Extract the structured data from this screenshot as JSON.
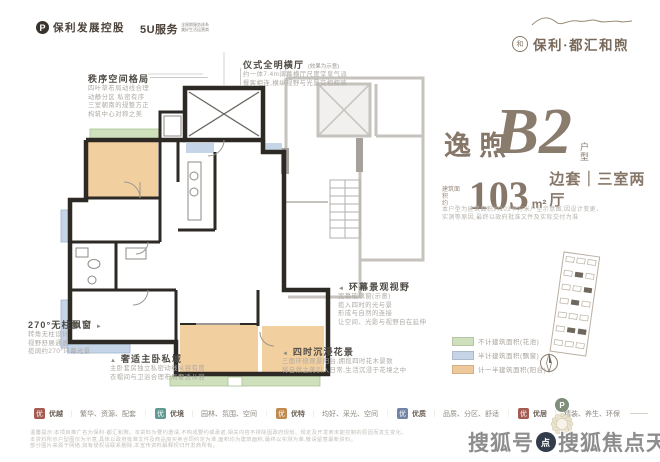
{
  "header": {
    "developer_mark": "P",
    "developer_name": "保利发展控股",
    "service_brand": "5U服务",
    "service_brand_sub1": "全周期服务体系",
    "service_brand_sub2": "美好生活运营商",
    "project_emblem": "和",
    "project_name": "保利·都汇和煦"
  },
  "unit": {
    "series_name": "逸煦",
    "unit_code": "B2",
    "unit_code_suffix": "户型",
    "area_prefix_line1": "建筑面积",
    "area_prefix_line2": "约",
    "area_value": "103",
    "area_unit": "m²",
    "area_layout": "边套｜三室两厅",
    "note_line1": "本户型为建筑面积约103平方米户型示意图,因设计变更、",
    "note_line2": "实测等原因,最终以政府批准文件及实际交付为准"
  },
  "annotations": {
    "order": {
      "title": "秩序空间格局",
      "lines": [
        "四叶草布局动线合理",
        "动静分区 私密有序",
        "三室朝南的规整方正",
        "构筑中心对称之美"
      ]
    },
    "hall": {
      "title": "仪式全明横厅",
      "suffix": "(效果为示意)",
      "lines": [
        "约一体7.4m阔幕横厅尺度堂皇气派",
        "餐客相连,横纵视野与光景交相辉映"
      ]
    },
    "view": {
      "title": "环幕景观视野",
      "arrow": "◄",
      "lines": [
        "宽幕玻璃窗(示意)",
        "揽入四时的光与景",
        "形成与自然的连接",
        "让空间、光影与视野自在延伸"
      ]
    },
    "baywindow": {
      "title": "270°无柱飘窗",
      "arrow": "►",
      "lines": [
        "转角无柱设计",
        "视野舒展通透",
        "揽阔约270°环幕光景"
      ]
    },
    "master": {
      "title": "奢适主卧私域",
      "arrow": "▲",
      "lines": [
        "主卧套房独立私密动线从容有度",
        "衣帽间与卫浴合理布局奢适从容"
      ]
    },
    "garden": {
      "title": "四时沉浸花景",
      "arrow": "◄",
      "lines": [
        "三面环绕观景阳台,拥揽四时花木景致",
        "将自然之美引入日常,生活沉浸于花境之中"
      ]
    }
  },
  "legend": {
    "items": [
      {
        "label": "不计建筑面积(花池)",
        "style": "background:#cfe0bd"
      },
      {
        "label": "半计建筑面积(飘窗)",
        "style": "background:#c5d4e6"
      },
      {
        "label": "计一半建筑面积(阳台)",
        "style": "background:#eec99b"
      }
    ],
    "colors": [
      "#cfe0bd",
      "#c5d4e6",
      "#eec99b"
    ]
  },
  "plan_colors": {
    "wall": "#2d2925",
    "neighbor": "#c6c3be",
    "flower_bed_green": "#cfe0bd",
    "bay_window_blue": "#c5d4e6",
    "balcony_orange": "#f2cf9e"
  },
  "services": {
    "icon_glyph": "优",
    "items": [
      {
        "name": "优越",
        "desc": "繁华、资源、配套",
        "style": "background:#a65b52"
      },
      {
        "name": "优境",
        "desc": "园林、氛围、空间",
        "style": "background:#5f9b93"
      },
      {
        "name": "优特",
        "desc": "均好、采光、空间",
        "style": "background:#c0894e"
      },
      {
        "name": "优质",
        "desc": "品质、分区、舒适",
        "style": "background:#7282a8"
      },
      {
        "name": "优居",
        "desc": "精装、养生、环保",
        "style": "background:#a65b52"
      }
    ]
  },
  "fine_print": [
    "温馨提示:本项目推广名为保利·都汇和煦。本资料为要约邀请,不构成要约或承诺,相关内容不排除因政府规划、规定及开发商未能控制的原因而发生变化。",
    "本资料所示户型图仅为示意,具体以政府批准文件及商品房买卖合同约定为准,面积均为建筑面积,最终以实测为准,敬请留意最新资料。",
    "部分图片来源于网络,如有侵权请联系删除,本宣传资料解释权归开发商所有。"
  ],
  "watermark": {
    "prefix": "搜狐号",
    "badge": "点",
    "suffix": "搜狐焦点天门站"
  }
}
